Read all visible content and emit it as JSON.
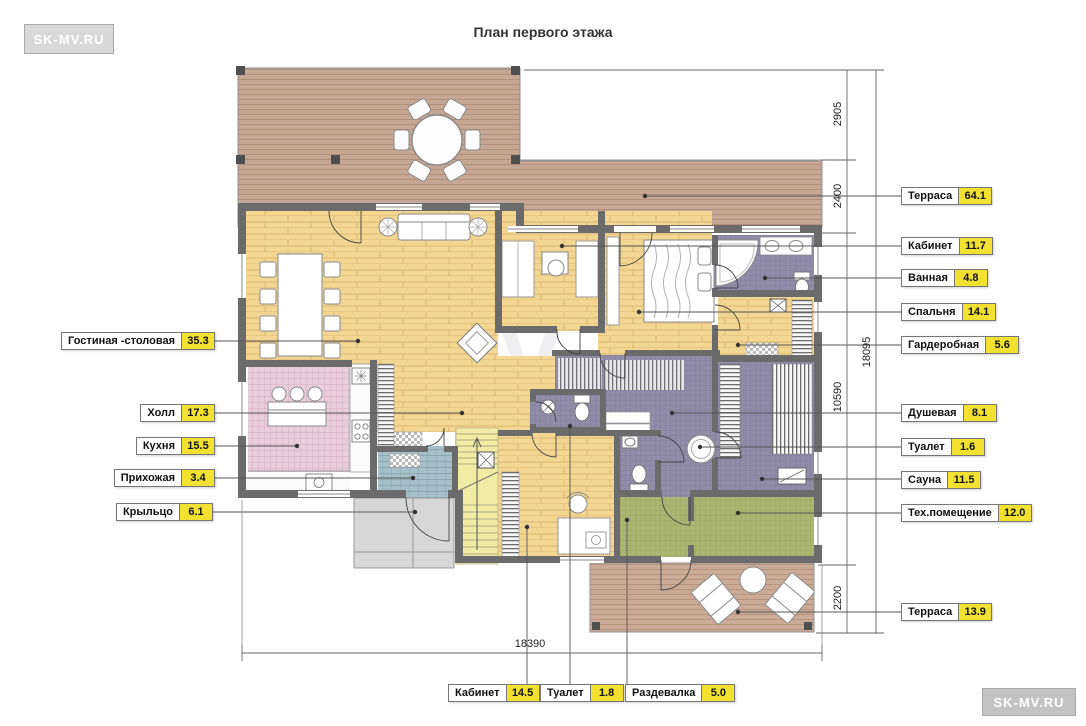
{
  "title": "План первого этажа",
  "logo_top_left": "SK-MV.RU",
  "logo_bottom_right": "SK-MV.RU",
  "watermark": "MV",
  "labels": {
    "left": [
      {
        "name": "Гостиная -столовая",
        "area": "35.3"
      },
      {
        "name": "Холл",
        "area": "17.3"
      },
      {
        "name": "Кухня",
        "area": "15.5"
      },
      {
        "name": "Прихожая",
        "area": "3.4"
      },
      {
        "name": "Крыльцо",
        "area": "6.1"
      }
    ],
    "right": [
      {
        "name": "Терраса",
        "area": "64.1"
      },
      {
        "name": "Кабинет",
        "area": "11.7"
      },
      {
        "name": "Ванная",
        "area": "4.8"
      },
      {
        "name": "Спальня",
        "area": "14.1"
      },
      {
        "name": "Гардеробная",
        "area": "5.6"
      },
      {
        "name": "Душевая",
        "area": "8.1"
      },
      {
        "name": "Туалет",
        "area": "1.6"
      },
      {
        "name": "Сауна",
        "area": "11.5"
      },
      {
        "name": "Тех.помещение",
        "area": "12.0"
      },
      {
        "name": "Терраса",
        "area": "13.9"
      }
    ],
    "bottom": [
      {
        "name": "Кабинет",
        "area": "14.5"
      },
      {
        "name": "Туалет",
        "area": "1.8"
      },
      {
        "name": "Раздевалка",
        "area": "5.0"
      }
    ]
  },
  "dimensions": {
    "right_chain": [
      "2905",
      "2400",
      "10590",
      "2200"
    ],
    "right_total": "18095",
    "bottom_total": "18390"
  },
  "colors": {
    "label_highlight": "#f2e130",
    "wall": "#6b6b6b",
    "wood_floor": "#f3d691",
    "terrace_deck": "#c6a795",
    "kitchen_tile": "#e8cddb",
    "bath_tile": "#918da9",
    "utility_tile": "#acb673",
    "entry_deck": "#a7bfc8",
    "stairs": "#f1eba4",
    "porch": "#d7d7d7"
  }
}
